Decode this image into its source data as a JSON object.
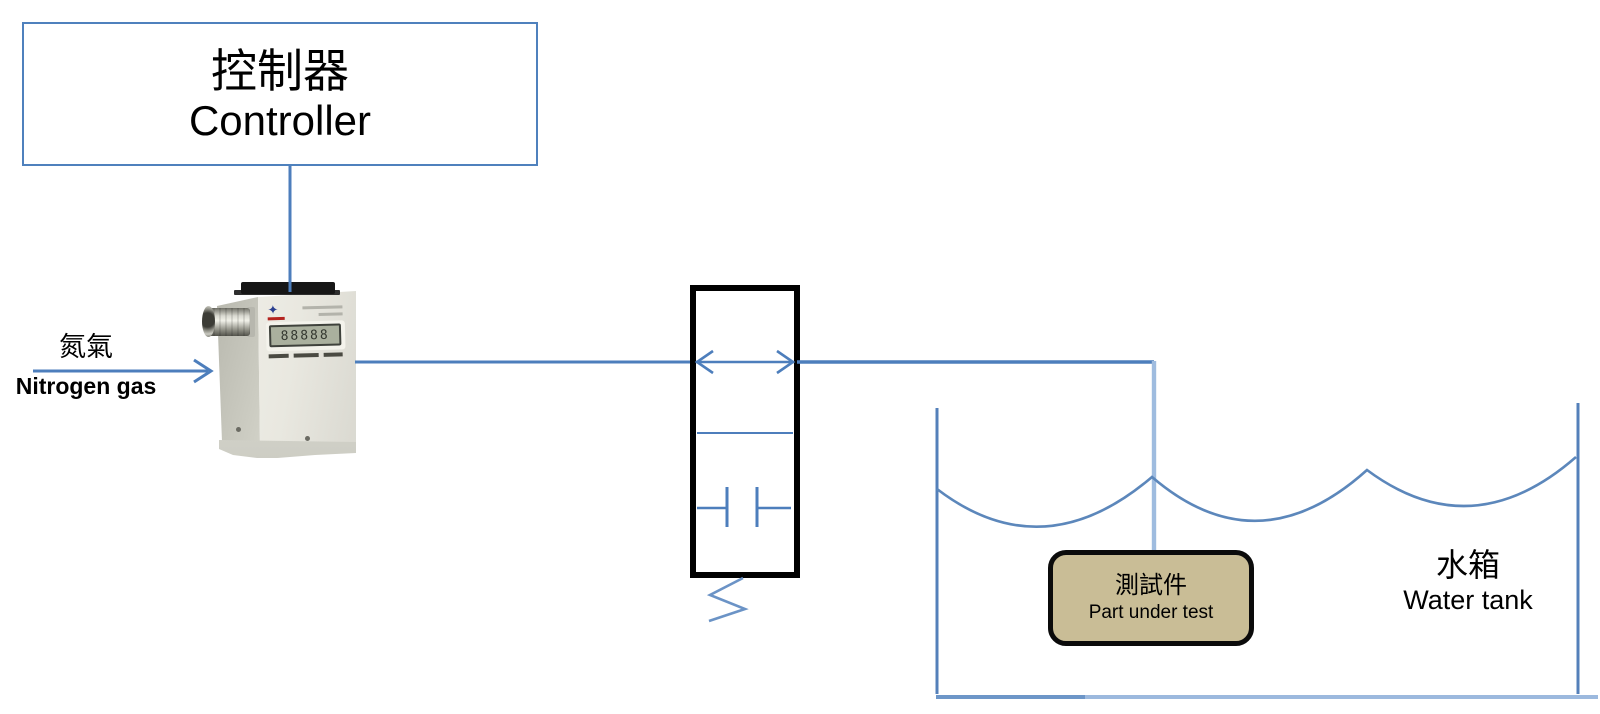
{
  "palette": {
    "line_blue": "#4d7ebc",
    "light_pipe_blue": "#9fbcdf",
    "wave_blue": "#5c87bb",
    "box_border_blue": "#4f81bd",
    "valve_black": "#000000",
    "part_fill_tan": "#c9bd96",
    "text_black": "#000000"
  },
  "controller": {
    "label_zh": "控制器",
    "label_en": "Controller"
  },
  "nitrogen_source": {
    "label_zh": "氮氣",
    "label_en": "Nitrogen gas"
  },
  "flow_device": {
    "lcd_digits": "88888"
  },
  "part_under_test": {
    "label_zh": "測試件",
    "label_en": "Part under test"
  },
  "water_tank": {
    "label_zh": "水箱",
    "label_en": "Water tank"
  }
}
